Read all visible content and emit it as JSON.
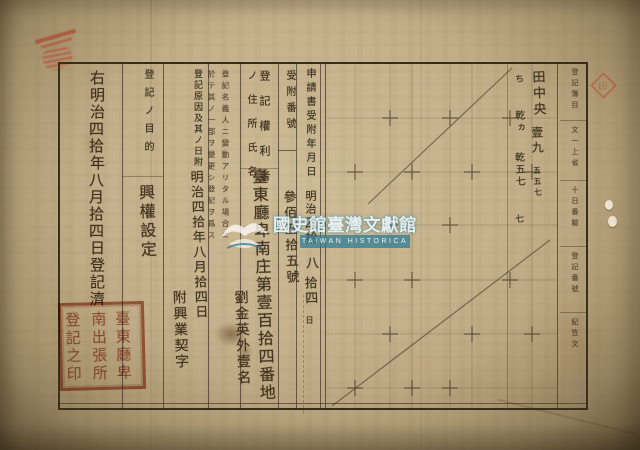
{
  "registration_summary": {
    "p1": "右明治",
    "h1": "四拾",
    "p2": "年",
    "h2": "八月拾四",
    "p3": "日登記濟"
  },
  "columns": {
    "purpose": {
      "label": "登記ノ目的",
      "value": "興權設定"
    },
    "cause": {
      "label": "登記原因及其ノ日附",
      "value1": "明治四拾年八月拾四日",
      "value2": "附興業契字"
    },
    "note": {
      "line1": "登記名義人ニ變動アリタル場合ニ",
      "line2": "於テ其ノ一部ヲ變更シ登記ヲ爲ス"
    },
    "rights_holder": {
      "label1": "登記權利者",
      "label2": "ノ住所氏名",
      "value1": "臺東廳卑南庄第壹百拾四番地",
      "value2": "劉金英外壹名"
    },
    "receipt_number": {
      "label": "受附番號",
      "value": "參佰五拾五號"
    },
    "application_date": {
      "label": "申請書受附年月日",
      "era": "明治",
      "h1": "四拾",
      "h2": "八",
      "h3": "拾四",
      "suffix": "日"
    },
    "property": {
      "col1": [
        "田中央",
        "壹九",
        "五五七"
      ],
      "col2": [
        "ち",
        "乾ヵ",
        "乾五七",
        "七"
      ]
    },
    "margin": {
      "segments": [
        "登記簿目",
        "文一上省",
        "十日番驗",
        "登記番號",
        "紀笠文"
      ]
    }
  },
  "seals": {
    "registry_cols": [
      "臺東廳卑",
      "南出張所",
      "登記之印"
    ],
    "diamond": "印"
  },
  "watermark": {
    "cn": "國史館臺灣文獻館",
    "en": "TAIWAN HISTORICA"
  },
  "colors": {
    "seal_red": "#b04c30",
    "watermark_teal": "#287a96",
    "ink": "#3d2f1d",
    "paper": "#c6b28d"
  }
}
